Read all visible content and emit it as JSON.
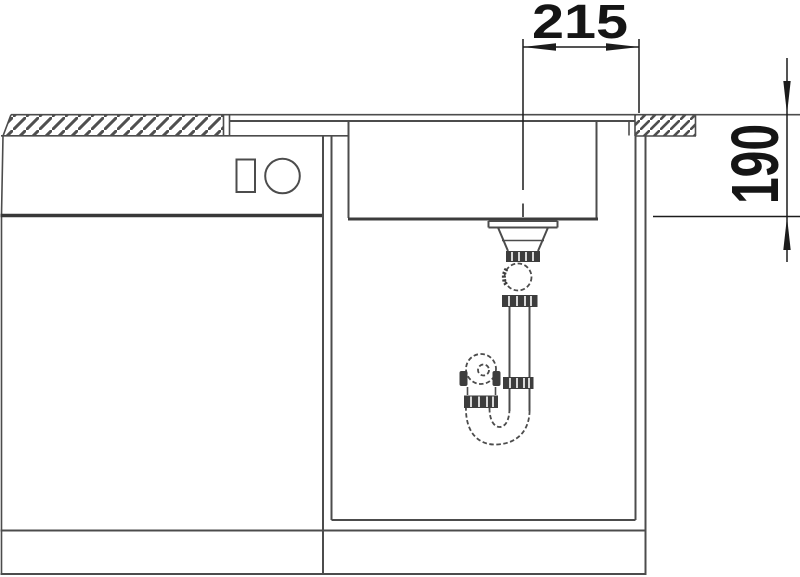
{
  "drawing": {
    "description": "Sink installation section drawing",
    "dimensions": {
      "horizontal_mm": "215",
      "vertical_mm": "190"
    },
    "parts": [
      "countertop-left-section",
      "countertop-right-section",
      "sink-rim",
      "sink-bowl",
      "drain-flange",
      "drain-tailpiece",
      "siphon-trap",
      "dishwasher-cabinet",
      "dishwasher-controls",
      "sink-cabinet",
      "plinth-base"
    ],
    "colors": {
      "background": "#ffffff",
      "line": "#4c4c4c",
      "line_dark": "#383838",
      "hatch": "#4f4f4f",
      "dimension_text": "#151515"
    }
  }
}
